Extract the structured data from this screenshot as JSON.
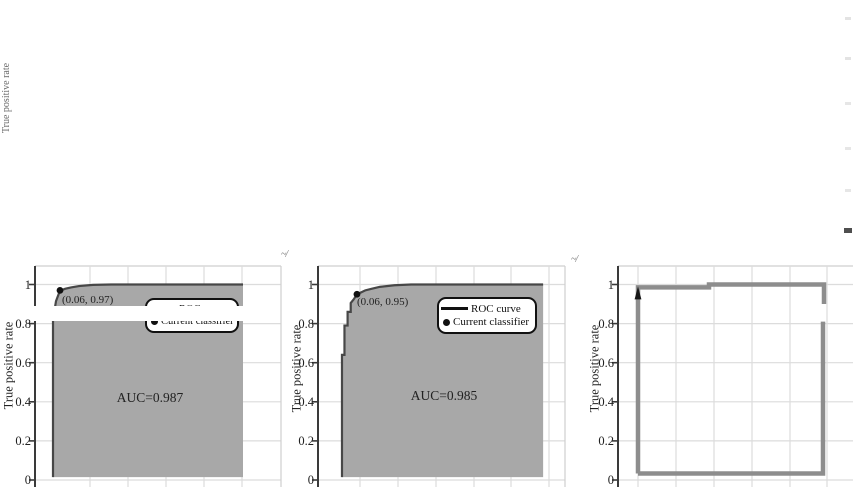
{
  "ghost": {
    "ylabel": "True positive rate"
  },
  "artifacts": {
    "stray_marks": [
      "~/",
      "~/"
    ]
  },
  "chart_data": [
    {
      "type": "area",
      "title": "",
      "xlabel": "",
      "ylabel": "True positive rate",
      "xlim": [
        0,
        1.25
      ],
      "ylim": [
        0,
        1.1
      ],
      "grid": true,
      "legend_position": "upper right",
      "fill_color": "#a8a8a8",
      "yticks": [
        {
          "label": "1",
          "value": 1
        },
        {
          "label": "0.8",
          "value": 0.8
        },
        {
          "label": "0.6",
          "value": 0.6
        },
        {
          "label": "0.4",
          "value": 0.4
        },
        {
          "label": "0.2",
          "value": 0.2
        },
        {
          "label": "0",
          "value": 0
        }
      ],
      "auc": 0.987,
      "auc_label": "AUC=0.987",
      "annotation": {
        "label": "(0.06, 0.97)",
        "x": 0.06,
        "y": 0.97
      },
      "legend": [
        "ROC curve",
        "Current classifier"
      ],
      "classifier_point": [
        0.095,
        0.97
      ],
      "series": [
        {
          "name": "ROC curve",
          "points": [
            [
              0.06,
              0.015
            ],
            [
              0.06,
              0.82
            ],
            [
              0.075,
              0.915
            ],
            [
              0.088,
              0.95
            ],
            [
              0.095,
              0.97
            ],
            [
              0.105,
              0.972
            ],
            [
              0.12,
              0.978
            ],
            [
              0.15,
              0.985
            ],
            [
              0.19,
              0.992
            ],
            [
              0.26,
              0.998
            ],
            [
              0.35,
              1
            ],
            [
              1.01,
              1
            ]
          ]
        }
      ]
    },
    {
      "type": "area",
      "title": "",
      "xlabel": "",
      "ylabel": "True positive rate",
      "xlim": [
        0,
        1.2
      ],
      "ylim": [
        0,
        1.1
      ],
      "grid": true,
      "legend_position": "upper right",
      "fill_color": "#a8a8a8",
      "yticks": [
        {
          "label": "1",
          "value": 1
        },
        {
          "label": "0.8",
          "value": 0.8
        },
        {
          "label": "0.6",
          "value": 0.6
        },
        {
          "label": "0.4",
          "value": 0.4
        },
        {
          "label": "0.2",
          "value": 0.2
        },
        {
          "label": "0",
          "value": 0
        }
      ],
      "auc": 0.985,
      "auc_label": "AUC=0.985",
      "annotation": {
        "label": "(0.06, 0.95)",
        "x": 0.06,
        "y": 0.95
      },
      "legend": [
        "ROC curve",
        "Current classifier"
      ],
      "classifier_point": [
        0.12,
        0.95
      ],
      "series": [
        {
          "name": "ROC curve",
          "points": [
            [
              0.048,
              0.015
            ],
            [
              0.048,
              0.64
            ],
            [
              0.06,
              0.64
            ],
            [
              0.06,
              0.79
            ],
            [
              0.075,
              0.79
            ],
            [
              0.075,
              0.86
            ],
            [
              0.09,
              0.86
            ],
            [
              0.09,
              0.905
            ],
            [
              0.105,
              0.925
            ],
            [
              0.12,
              0.95
            ],
            [
              0.14,
              0.96
            ],
            [
              0.16,
              0.97
            ],
            [
              0.19,
              0.978
            ],
            [
              0.23,
              0.988
            ],
            [
              0.3,
              0.996
            ],
            [
              0.38,
              1
            ],
            [
              1.015,
              1
            ]
          ]
        }
      ]
    },
    {
      "type": "line",
      "title": "",
      "xlabel": "",
      "ylabel": "True positive rate",
      "xlim": [
        0,
        1.2
      ],
      "ylim": [
        0,
        1.1
      ],
      "grid": true,
      "line_color": "#8d8d8d",
      "yticks": [
        {
          "label": "1",
          "value": 1
        },
        {
          "label": "0.8",
          "value": 0.8
        },
        {
          "label": "0.6",
          "value": 0.6
        },
        {
          "label": "0.4",
          "value": 0.4
        },
        {
          "label": "0.2",
          "value": 0.2
        },
        {
          "label": "0",
          "value": 0
        }
      ],
      "classifier_point": [
        0.075,
        0.96
      ],
      "series": [
        {
          "name": "ROC curve",
          "points": [
            [
              0.075,
              0.033
            ],
            [
              0.075,
              0.985
            ],
            [
              0.43,
              0.985
            ],
            [
              0.43,
              1
            ],
            [
              1.005,
              1
            ],
            [
              1.005,
              0.9
            ]
          ]
        },
        {
          "name": "ROC curve lower segment",
          "points": [
            [
              1.0,
              0.81
            ],
            [
              1.0,
              0.033
            ],
            [
              0.075,
              0.033
            ]
          ]
        }
      ]
    }
  ]
}
